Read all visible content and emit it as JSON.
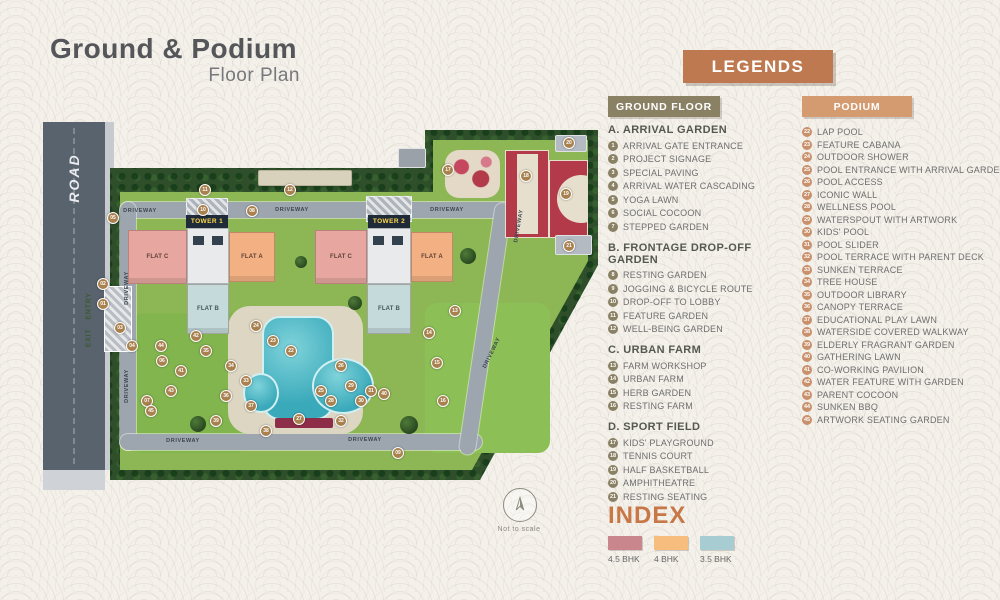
{
  "title": {
    "main": "Ground & Podium",
    "sub": "Floor Plan"
  },
  "colors": {
    "legends_bg": "#bf7950",
    "ground_header_bg": "#8a8165",
    "podium_header_bg": "#d49a70",
    "index_title": "#c87747",
    "bhk_45": "#c9878d",
    "bhk_4": "#f7bd7e",
    "bhk_35": "#a7ccd1"
  },
  "legends": {
    "header": "LEGENDS",
    "ground_floor": {
      "header": "GROUND FLOOR",
      "sections": [
        {
          "heading": "A. ARRIVAL GARDEN",
          "items": [
            {
              "num": "1",
              "label": "ARRIVAL GATE ENTRANCE"
            },
            {
              "num": "2",
              "label": "PROJECT SIGNAGE"
            },
            {
              "num": "3",
              "label": "SPECIAL PAVING"
            },
            {
              "num": "4",
              "label": "ARRIVAL WATER CASCADING"
            },
            {
              "num": "5",
              "label": "YOGA LAWN"
            },
            {
              "num": "6",
              "label": "SOCIAL COCOON"
            },
            {
              "num": "7",
              "label": "STEPPED GARDEN"
            }
          ]
        },
        {
          "heading": "B. FRONTAGE DROP-OFF GARDEN",
          "items": [
            {
              "num": "8",
              "label": "RESTING GARDEN"
            },
            {
              "num": "9",
              "label": "JOGGING & BICYCLE ROUTE"
            },
            {
              "num": "10",
              "label": "DROP-OFF TO LOBBY"
            },
            {
              "num": "11",
              "label": "FEATURE GARDEN"
            },
            {
              "num": "12",
              "label": "WELL-BEING GARDEN"
            }
          ]
        },
        {
          "heading": "C. URBAN FARM",
          "items": [
            {
              "num": "13",
              "label": "FARM WORKSHOP"
            },
            {
              "num": "14",
              "label": "URBAN FARM"
            },
            {
              "num": "15",
              "label": "HERB GARDEN"
            },
            {
              "num": "16",
              "label": "RESTING FARM"
            }
          ]
        },
        {
          "heading": "D. SPORT FIELD",
          "items": [
            {
              "num": "17",
              "label": "KIDS' PLAYGROUND"
            },
            {
              "num": "18",
              "label": "TENNIS COURT"
            },
            {
              "num": "19",
              "label": "HALF BASKETBALL"
            },
            {
              "num": "20",
              "label": "AMPHITHEATRE"
            },
            {
              "num": "21",
              "label": "RESTING SEATING"
            }
          ]
        }
      ]
    },
    "podium": {
      "header": "PODIUM",
      "items": [
        {
          "num": "22",
          "label": "LAP POOL"
        },
        {
          "num": "23",
          "label": "FEATURE CABANA"
        },
        {
          "num": "24",
          "label": "OUTDOOR SHOWER"
        },
        {
          "num": "25",
          "label": "POOL ENTRANCE WITH ARRIVAL GARDEN"
        },
        {
          "num": "26",
          "label": "POOL ACCESS"
        },
        {
          "num": "27",
          "label": "ICONIC WALL"
        },
        {
          "num": "28",
          "label": "WELLNESS POOL"
        },
        {
          "num": "29",
          "label": "WATERSPOUT WITH ARTWORK"
        },
        {
          "num": "30",
          "label": "KIDS' POOL"
        },
        {
          "num": "31",
          "label": "POOL SLIDER"
        },
        {
          "num": "32",
          "label": "POOL TERRACE WITH PARENT DECK"
        },
        {
          "num": "33",
          "label": "SUNKEN TERRACE"
        },
        {
          "num": "34",
          "label": "TREE HOUSE"
        },
        {
          "num": "35",
          "label": "OUTDOOR LIBRARY"
        },
        {
          "num": "36",
          "label": "CANOPY TERRACE"
        },
        {
          "num": "37",
          "label": "EDUCATIONAL PLAY LAWN"
        },
        {
          "num": "38",
          "label": "WATERSIDE COVERED WALKWAY"
        },
        {
          "num": "39",
          "label": "ELDERLY FRAGRANT GARDEN"
        },
        {
          "num": "40",
          "label": "GATHERING LAWN"
        },
        {
          "num": "41",
          "label": "CO-WORKING PAVILION"
        },
        {
          "num": "42",
          "label": "WATER FEATURE WITH GARDEN"
        },
        {
          "num": "43",
          "label": "PARENT COCOON"
        },
        {
          "num": "44",
          "label": "SUNKEN BBQ"
        },
        {
          "num": "45",
          "label": "ARTWORK SEATING GARDEN"
        }
      ]
    }
  },
  "index": {
    "title": "INDEX",
    "items": [
      {
        "label": "4.5 BHK",
        "color": "#c9878d"
      },
      {
        "label": "4 BHK",
        "color": "#f7bd7e"
      },
      {
        "label": "3.5 BHK",
        "color": "#a7ccd1"
      }
    ]
  },
  "map": {
    "road_label": "ROAD",
    "entry_label": "ENTRY",
    "exit_label": "EXIT",
    "not_to_scale": "Not to scale",
    "towers": [
      {
        "name": "TOWER 1",
        "flat_left": "FLAT C",
        "flat_right": "FLAT A",
        "flat_bottom": "FLAT B"
      },
      {
        "name": "TOWER 2",
        "flat_left": "FLAT C",
        "flat_right": "FLAT A",
        "flat_bottom": "FLAT B"
      }
    ],
    "driveway_labels": [
      {
        "text": "DRIVEWAY",
        "x": 100,
        "y": 93,
        "rot": 0
      },
      {
        "text": "DRIVEWAY",
        "x": 252,
        "y": 92,
        "rot": 0
      },
      {
        "text": "DRIVEWAY",
        "x": 407,
        "y": 92,
        "rot": 0
      },
      {
        "text": "DRIVEWAY",
        "x": 87,
        "y": 170,
        "rot": -90
      },
      {
        "text": "DRIVEWAY",
        "x": 87,
        "y": 268,
        "rot": -90
      },
      {
        "text": "DRIVEWAY",
        "x": 143,
        "y": 323,
        "rot": 0
      },
      {
        "text": "DRIVEWAY",
        "x": 325,
        "y": 322,
        "rot": 0
      },
      {
        "text": "DRIVEWAY",
        "x": 479,
        "y": 108,
        "rot": -80
      },
      {
        "text": "DRIVEWAY",
        "x": 452,
        "y": 235,
        "rot": -64
      }
    ],
    "markers": [
      {
        "n": "01",
        "x": 63,
        "y": 186
      },
      {
        "n": "02",
        "x": 63,
        "y": 166
      },
      {
        "n": "03",
        "x": 80,
        "y": 210
      },
      {
        "n": "04",
        "x": 92,
        "y": 228
      },
      {
        "n": "05",
        "x": 73,
        "y": 100
      },
      {
        "n": "06",
        "x": 122,
        "y": 243
      },
      {
        "n": "07",
        "x": 107,
        "y": 283
      },
      {
        "n": "08",
        "x": 212,
        "y": 93
      },
      {
        "n": "09",
        "x": 358,
        "y": 335
      },
      {
        "n": "10",
        "x": 163,
        "y": 92
      },
      {
        "n": "11",
        "x": 165,
        "y": 72
      },
      {
        "n": "12",
        "x": 250,
        "y": 72
      },
      {
        "n": "13",
        "x": 415,
        "y": 193
      },
      {
        "n": "14",
        "x": 389,
        "y": 215
      },
      {
        "n": "15",
        "x": 397,
        "y": 245
      },
      {
        "n": "16",
        "x": 403,
        "y": 283
      },
      {
        "n": "17",
        "x": 408,
        "y": 52
      },
      {
        "n": "18",
        "x": 486,
        "y": 58
      },
      {
        "n": "19",
        "x": 526,
        "y": 76
      },
      {
        "n": "20",
        "x": 529,
        "y": 25
      },
      {
        "n": "21",
        "x": 529,
        "y": 128
      },
      {
        "n": "22",
        "x": 251,
        "y": 233
      },
      {
        "n": "23",
        "x": 233,
        "y": 223
      },
      {
        "n": "24",
        "x": 216,
        "y": 208
      },
      {
        "n": "25",
        "x": 281,
        "y": 273
      },
      {
        "n": "26",
        "x": 301,
        "y": 248
      },
      {
        "n": "27",
        "x": 259,
        "y": 301
      },
      {
        "n": "28",
        "x": 291,
        "y": 283
      },
      {
        "n": "29",
        "x": 311,
        "y": 268
      },
      {
        "n": "30",
        "x": 321,
        "y": 283
      },
      {
        "n": "31",
        "x": 331,
        "y": 273
      },
      {
        "n": "32",
        "x": 301,
        "y": 303
      },
      {
        "n": "33",
        "x": 206,
        "y": 263
      },
      {
        "n": "34",
        "x": 191,
        "y": 248
      },
      {
        "n": "35",
        "x": 166,
        "y": 233
      },
      {
        "n": "36",
        "x": 186,
        "y": 278
      },
      {
        "n": "37",
        "x": 211,
        "y": 288
      },
      {
        "n": "38",
        "x": 226,
        "y": 313
      },
      {
        "n": "39",
        "x": 176,
        "y": 303
      },
      {
        "n": "40",
        "x": 344,
        "y": 276
      },
      {
        "n": "41",
        "x": 141,
        "y": 253
      },
      {
        "n": "42",
        "x": 156,
        "y": 218
      },
      {
        "n": "43",
        "x": 131,
        "y": 273
      },
      {
        "n": "44",
        "x": 121,
        "y": 228
      },
      {
        "n": "45",
        "x": 111,
        "y": 293
      }
    ]
  }
}
